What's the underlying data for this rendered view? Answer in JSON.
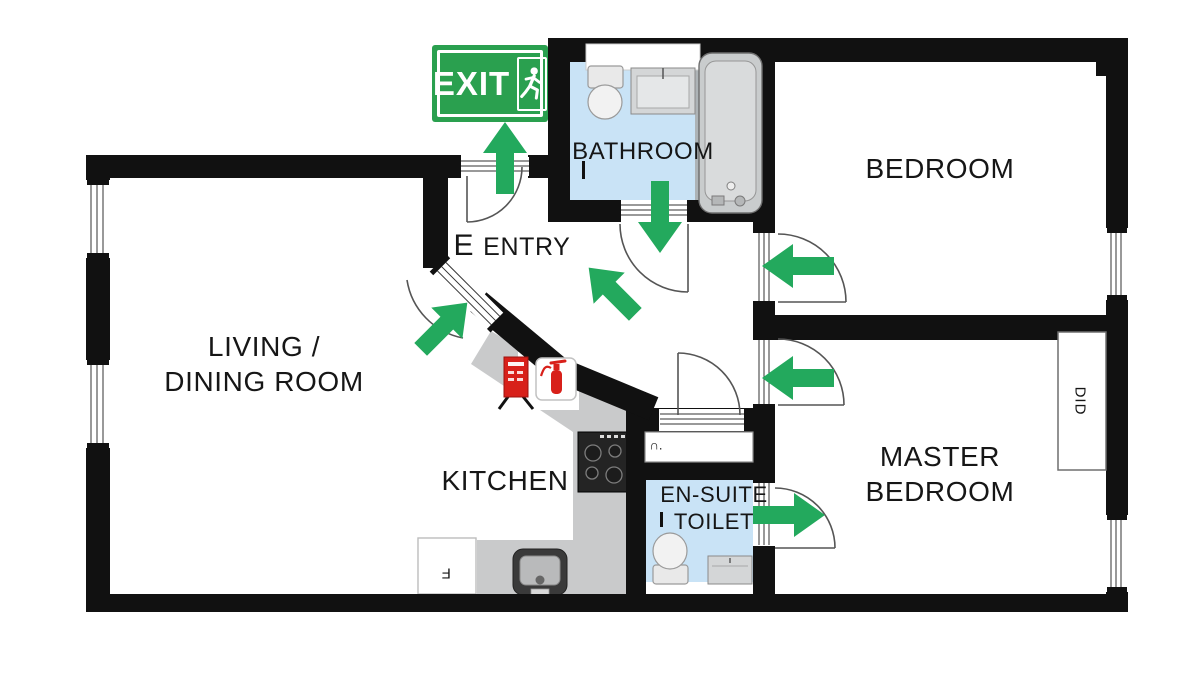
{
  "title": "Apartment fire evacuation floor plan",
  "exit_sign": {
    "label": "EXIT",
    "icon": "running-man-icon"
  },
  "rooms": {
    "bathroom": {
      "label": "BATHROOM"
    },
    "bedroom": {
      "label": "BEDROOM"
    },
    "entry": {
      "marker": "E",
      "label": "ENTRY"
    },
    "living_dining": {
      "line1": "LIVING /",
      "line2": "DINING ROOM"
    },
    "kitchen": {
      "label": "KITCHEN"
    },
    "ensuite": {
      "line1": "EN-SUITE",
      "line2": "TOILET"
    },
    "master_bedroom": {
      "line1": "MASTER",
      "line2": "BEDROOM"
    }
  },
  "labels": {
    "wardrobe": "DID",
    "hall_cupboard": "∩.",
    "fridge": "F"
  },
  "icons": {
    "exit_running_man": "running-man-icon",
    "fire_extinguisher": "fire-extinguisher-icon",
    "fire_point_sign": "fire-point-sign-icon",
    "evacuation_arrow": "evacuation-arrow-icon"
  },
  "colors": {
    "wall_black": "#111111",
    "arrow_green": "#23A95D",
    "exit_sign_green": "#2AA04F",
    "floor_blue": "#C9E3F6",
    "counter_gray": "#C9CACB",
    "fixture_gray": "#D6D8D9",
    "alarm_red": "#D8201A"
  }
}
